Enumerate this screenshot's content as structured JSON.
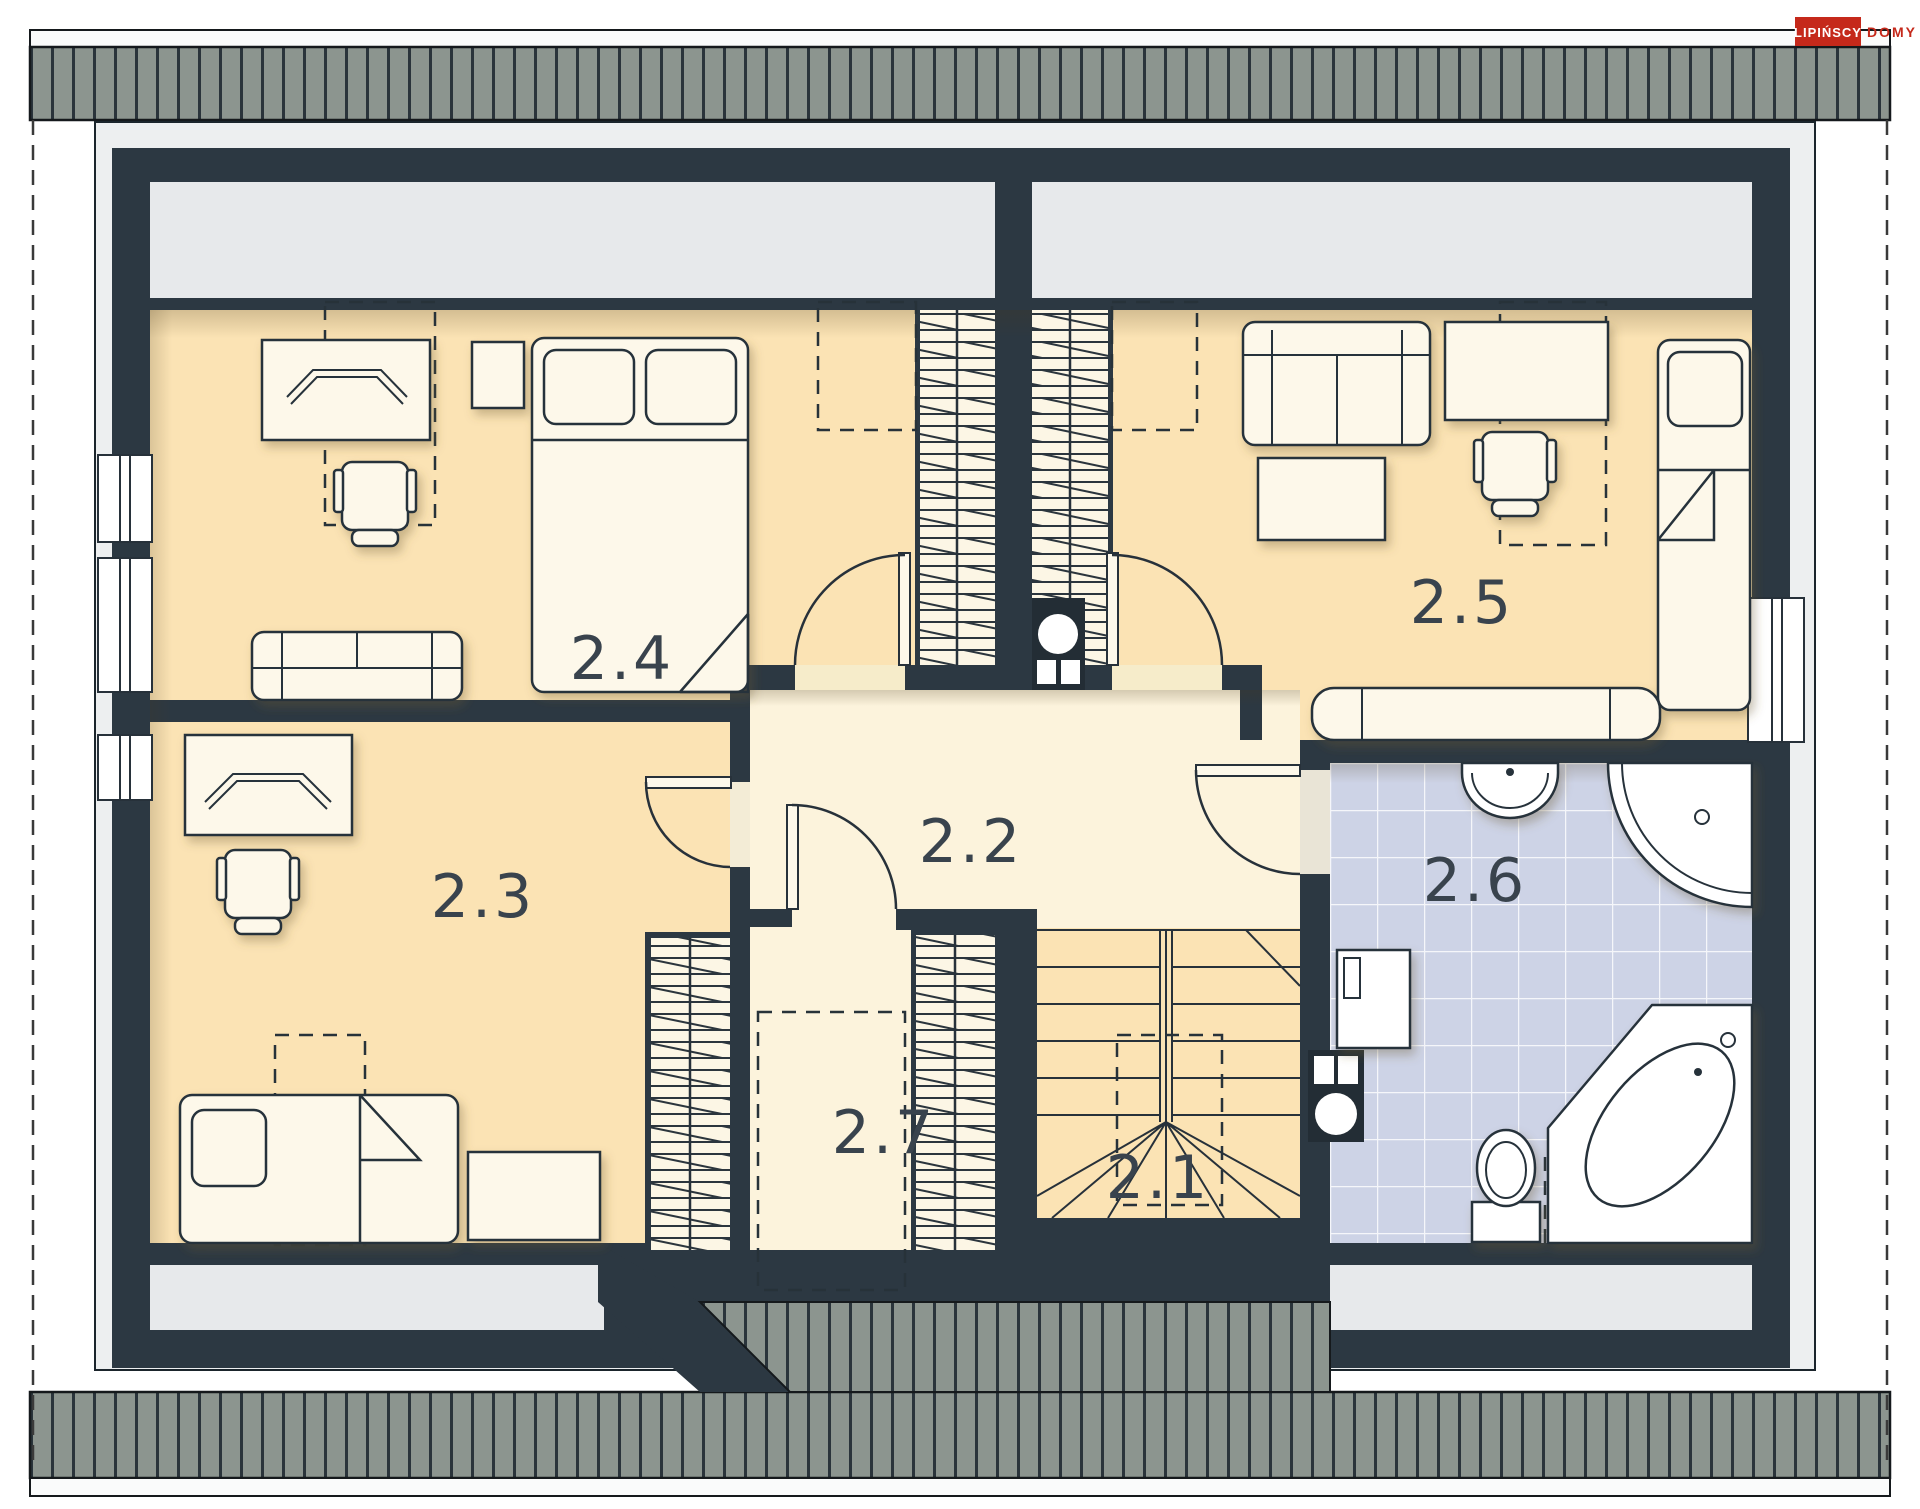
{
  "logo": {
    "primary": "LIPIŃSCY",
    "secondary": "DOMY",
    "primary_bg": "#c5291b",
    "secondary_color": "#c5291b"
  },
  "plan": {
    "title": "Attic floor plan",
    "rooms": [
      {
        "id": "2.1",
        "label": "2.1",
        "name": "staircase"
      },
      {
        "id": "2.2",
        "label": "2.2",
        "name": "hallway"
      },
      {
        "id": "2.3",
        "label": "2.3",
        "name": "bedroom"
      },
      {
        "id": "2.4",
        "label": "2.4",
        "name": "bedroom"
      },
      {
        "id": "2.5",
        "label": "2.5",
        "name": "bedroom"
      },
      {
        "id": "2.6",
        "label": "2.6",
        "name": "bathroom"
      },
      {
        "id": "2.7",
        "label": "2.7",
        "name": "storage"
      }
    ]
  },
  "palette": {
    "wall": "#2c3842",
    "floor_warm": "#fbe3b4",
    "floor_pale": "#fcf3dc",
    "floor_light": "#fcf6e5",
    "bath_tile": "#cdd3e6",
    "roof": "#8c958f",
    "eaves": "#edeff0",
    "line": "#27313a",
    "label": "#39434d",
    "logo_red": "#c5291b"
  }
}
